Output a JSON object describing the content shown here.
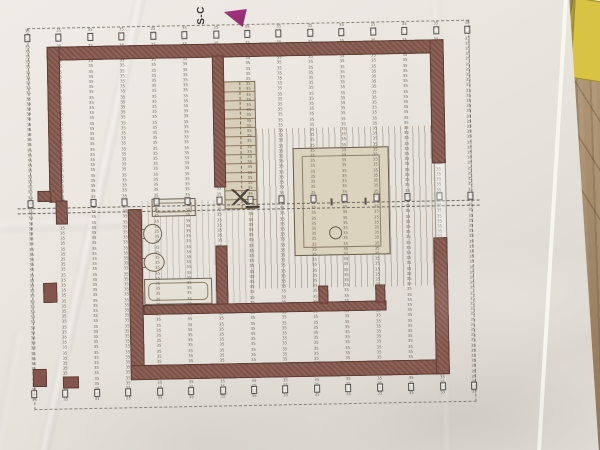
{
  "photo": {
    "surface": {
      "table_color": "#a98f6e",
      "folder_color": "#d8c342",
      "paper_color": "#e9e5df"
    }
  },
  "plan": {
    "section_marker": {
      "label": "S-C",
      "flag_color": "#a63384"
    },
    "rafters": {
      "tick_label": "35",
      "count": 15,
      "rows": 72
    },
    "walls": {
      "color": "#84564b"
    },
    "stairs": {
      "tread_count": 13
    },
    "floor": {
      "stripe_color": "#7a6652"
    }
  }
}
